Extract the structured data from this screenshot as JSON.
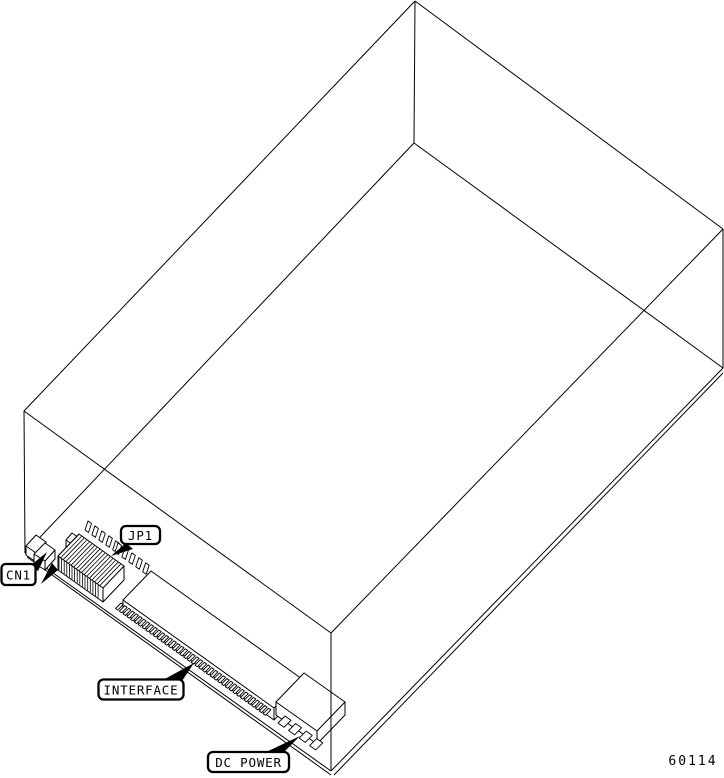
{
  "diagram": {
    "callouts": {
      "cn1": "CN1",
      "jp1": "JP1",
      "interface": "INTERFACE",
      "dc_power": "DC POWER"
    },
    "figure_number": "60114",
    "colors": {
      "line": "#000000",
      "background": "#ffffff"
    }
  }
}
